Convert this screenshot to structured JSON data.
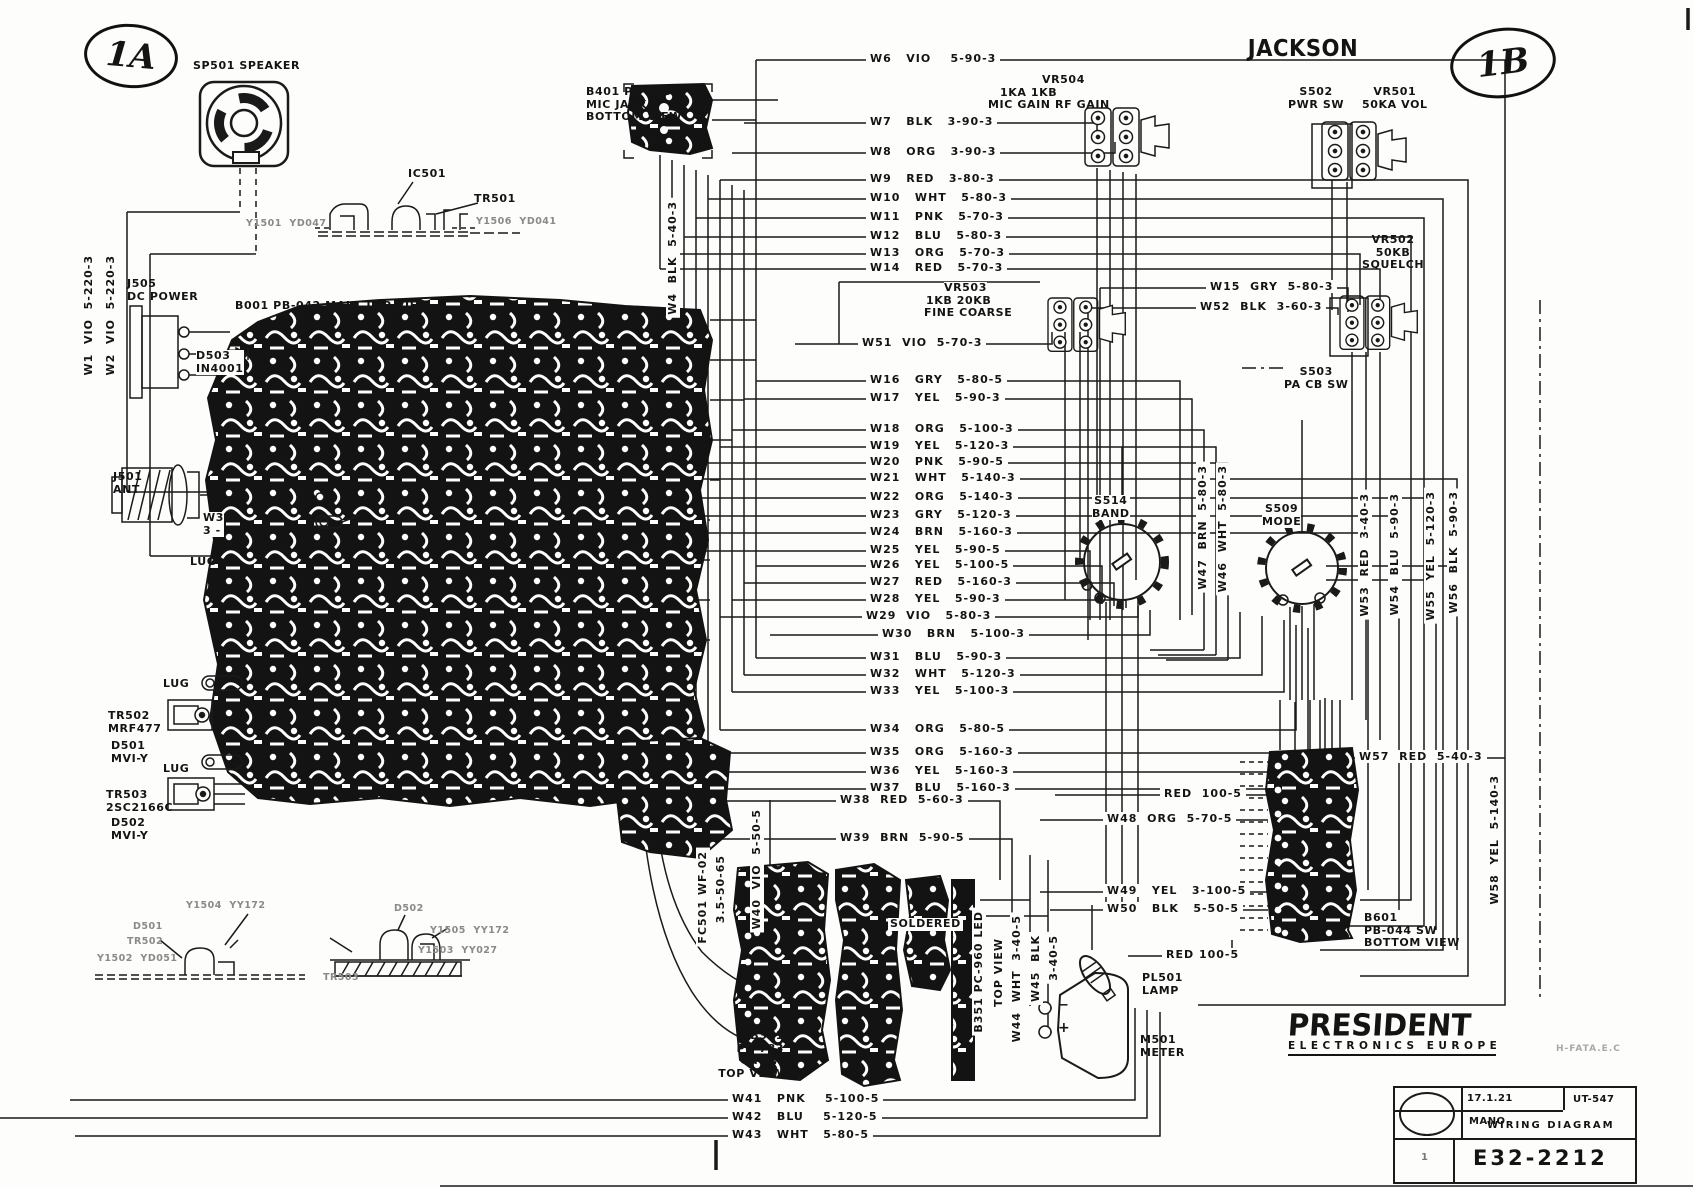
{
  "sheet": {
    "ref_left": "1A",
    "ref_right": "1B",
    "title": "JACKSON",
    "side_code": "H-FATA.E.C"
  },
  "logo": {
    "name": "PRESIDENT",
    "subtitle": "ELECTRONICS EUROPE"
  },
  "title_block": {
    "date": "17.1.21",
    "author": "MANO",
    "doc_no": "UT-547",
    "doc_title": "WIRING DIAGRAM",
    "drawing_no": "E32-2212",
    "sheet_no": "1"
  },
  "components": {
    "sp501": "SP501 SPEAKER",
    "ic501": "IC501",
    "tr501": "TR501",
    "y1501": "Y1501  YD047",
    "y1506": "Y1506  YD041",
    "j505": "J505\nDC POWER",
    "d503": "D503\nIN4001",
    "b001": "B001  PB-042    MAIN TOP VIEW",
    "j501": "J501\nANT",
    "w3_stub": "W3\n3 -",
    "lug_ant": "LUG",
    "lug_a": "LUG",
    "tr502": "TR502\nMRF477",
    "d501": "D501\nMVI-Y",
    "lug_b": "LUG",
    "tr503": "TR503\n2SC2166C",
    "d502": "D502\nMVI-Y",
    "b401": "B401 PC-266\nMIC JACK\nBOTTOM VIEW",
    "vr504": "VR504",
    "vr504_values": "1KA        1KB",
    "vr504_funcs": "MIC GAIN  RF GAIN",
    "s502": "S502\nPWR SW",
    "vr501": "VR501\n50KA VOL",
    "vr502": "VR502\n50KB\nSQUELCH",
    "vr503": "VR503",
    "vr503_values": "1KB      20KB",
    "vr503_funcs": "FINE   COARSE",
    "s503": "S503\nPA CB SW",
    "s514": "S514\nBAND",
    "s509": "S509\nMODE",
    "b601": "B601\nPB-044 SW\nBOTTOM VIEW",
    "b301": "B301\nPC-783\nCH SW\nTOP VIEW",
    "b351": "B351 PC-960 LED",
    "b351_view": "TOP VIEW",
    "soldered": "SOLDERED",
    "pl501": "PL501\nLAMP",
    "m501": "M501\nMETER",
    "meter_plus": "+",
    "meter_minus": "−",
    "fc501": "FC501 WF-02",
    "fc501_spec": "3.5-50-65",
    "y1504": "Y1504  YY172",
    "d501_side": "D501",
    "tr502_side": "TR502",
    "y1502": "Y1502  YD051",
    "d502_side": "D502",
    "y1505": "Y1505  YY172",
    "y1503": "Y1503  YY027",
    "tr503_side": "TR503"
  },
  "wires": {
    "w1": "W1  VIO  5-220-3",
    "w2": "W2  VIO  5-220-3",
    "w4": "W4  BLK  5-40-3",
    "w6": "W6   VIO    5-90-3",
    "w7": "W7   BLK   3-90-3",
    "w8": "W8   ORG   3-90-3",
    "w9": "W9   RED   3-80-3",
    "w10": "W10   WHT   5-80-3",
    "w11": "W11   PNK   5-70-3",
    "w12": "W12   BLU   5-80-3",
    "w13": "W13   ORG   5-70-3",
    "w14": "W14   RED   5-70-3",
    "w15": "W15  GRY  5-80-3",
    "w16": "W16   GRY   5-80-5",
    "w17": "W17   YEL   5-90-3",
    "w18": "W18   ORG   5-100-3",
    "w19": "W19   YEL   5-120-3",
    "w20": "W20   PNK   5-90-5",
    "w21": "W21   WHT   5-140-3",
    "w22": "W22   ORG   5-140-3",
    "w23": "W23   GRY   5-120-3",
    "w24": "W24   BRN   5-160-3",
    "w25": "W25   YEL   5-90-5",
    "w26": "W26   YEL   5-100-5",
    "w27": "W27   RED   5-160-3",
    "w28": "W28   YEL   5-90-3",
    "w29": "W29  VIO   5-80-3",
    "w30": "W30   BRN   5-100-3",
    "w31": "W31   BLU   5-90-3",
    "w32": "W32   WHT   5-120-3",
    "w33": "W33   YEL   5-100-3",
    "w34": "W34   ORG   5-80-5",
    "w35": "W35   ORG   5-160-3",
    "w36": "W36   YEL   5-160-3",
    "w37": "W37   BLU   5-160-3",
    "w38": "W38  RED  5-60-3",
    "w39": "W39  BRN  5-90-5",
    "w40": "W40  VIO  5-50-5",
    "w41": "W41   PNK    5-100-5",
    "w42": "W42   BLU    5-120-5",
    "w43": "W43   WHT   5-80-5",
    "w44": "W44  WHT  3-40-5",
    "w45a": "W45  BLK",
    "w45b": "3-40-5",
    "w46": "W46  WHT  5-80-3",
    "w47": "W47  BRN  5-80-3",
    "w48": "W48  ORG  5-70-5",
    "w49": "W49   YEL   3-100-5",
    "w50": "W50   BLK   5-50-5",
    "w51": "W51  VIO  5-70-3",
    "w52": "W52  BLK  3-60-3",
    "w53": "W53  RED  3-40-3",
    "w54": "W54  BLU  5-90-3",
    "w55": "W55  YEL  5-120-3",
    "w56": "W56  BLK  5-90-3",
    "w57": "W57  RED  5-40-3",
    "w58": "W58  YEL  5-140-3",
    "red_1": "RED  100-5",
    "red_2": "RED 100-5"
  }
}
